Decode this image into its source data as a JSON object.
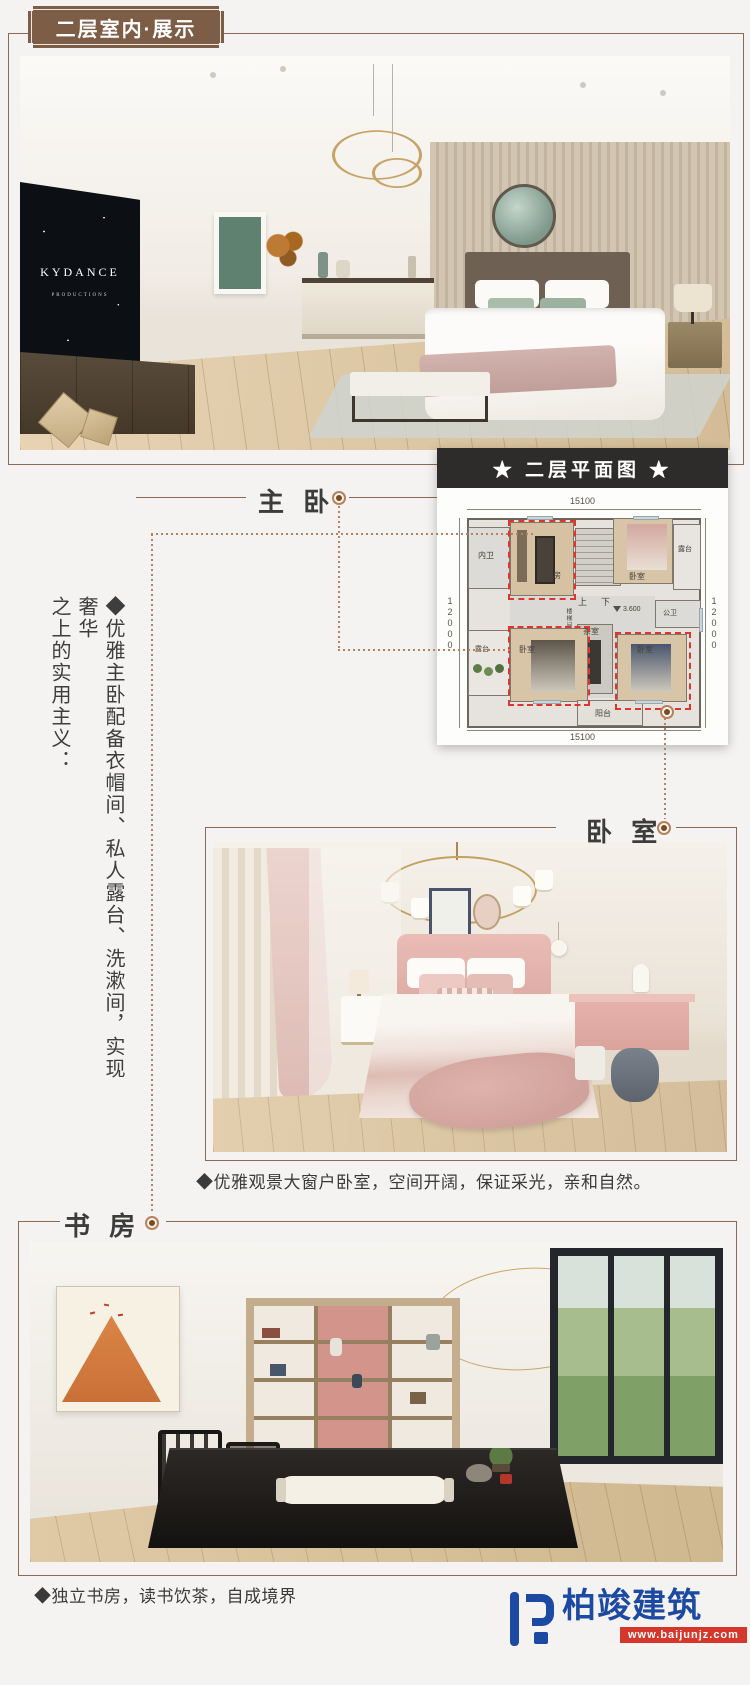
{
  "badge": {
    "label": "二层室内·展示"
  },
  "master": {
    "label": "主 卧",
    "tv": {
      "line1": "KYDANCE",
      "line2": "PRODUCTIONS"
    }
  },
  "floorplan": {
    "title": "★ 二层平面图 ★",
    "dims": {
      "top": "15100",
      "bottom": "15100",
      "left": "12000",
      "right": "12000"
    },
    "rooms": {
      "inner_bath": "内卫",
      "study": "书房",
      "bedroom_top": "卧室",
      "terrace_right": "露台",
      "public_bath": "公卫",
      "tea_room": "茶室",
      "bedroom_left": "卧室",
      "bedroom_right": "卧室",
      "terrace_left": "露台",
      "balcony": "阳台",
      "stair_up": "上",
      "stair_down": "下",
      "stair_core": "楼梯间",
      "elevation": "3.600"
    }
  },
  "side_note": {
    "col1": "◆优雅主卧配备衣帽间、私人露台、洗漱间，实现奢华",
    "col2": "之上的实用主义："
  },
  "bedroom": {
    "label": "卧 室",
    "caption": "◆优雅观景大窗户卧室，空间开阔，保证采光，亲和自然。"
  },
  "study": {
    "label": "书 房",
    "caption": "◆独立书房，读书饮茶，自成境界"
  },
  "logo": {
    "name": "柏竣建筑",
    "site": "www.baijunjz.com"
  },
  "colors": {
    "page_bg": "#f4f3f1",
    "badge_brown": "#7d5d45",
    "frame_brown": "#8a6a52",
    "connector": "#b5825c",
    "plan_header_bg": "#2d2c2a",
    "highlight_red": "#e0352b",
    "logo_blue": "#1c49a2",
    "logo_red": "#d6372b"
  }
}
